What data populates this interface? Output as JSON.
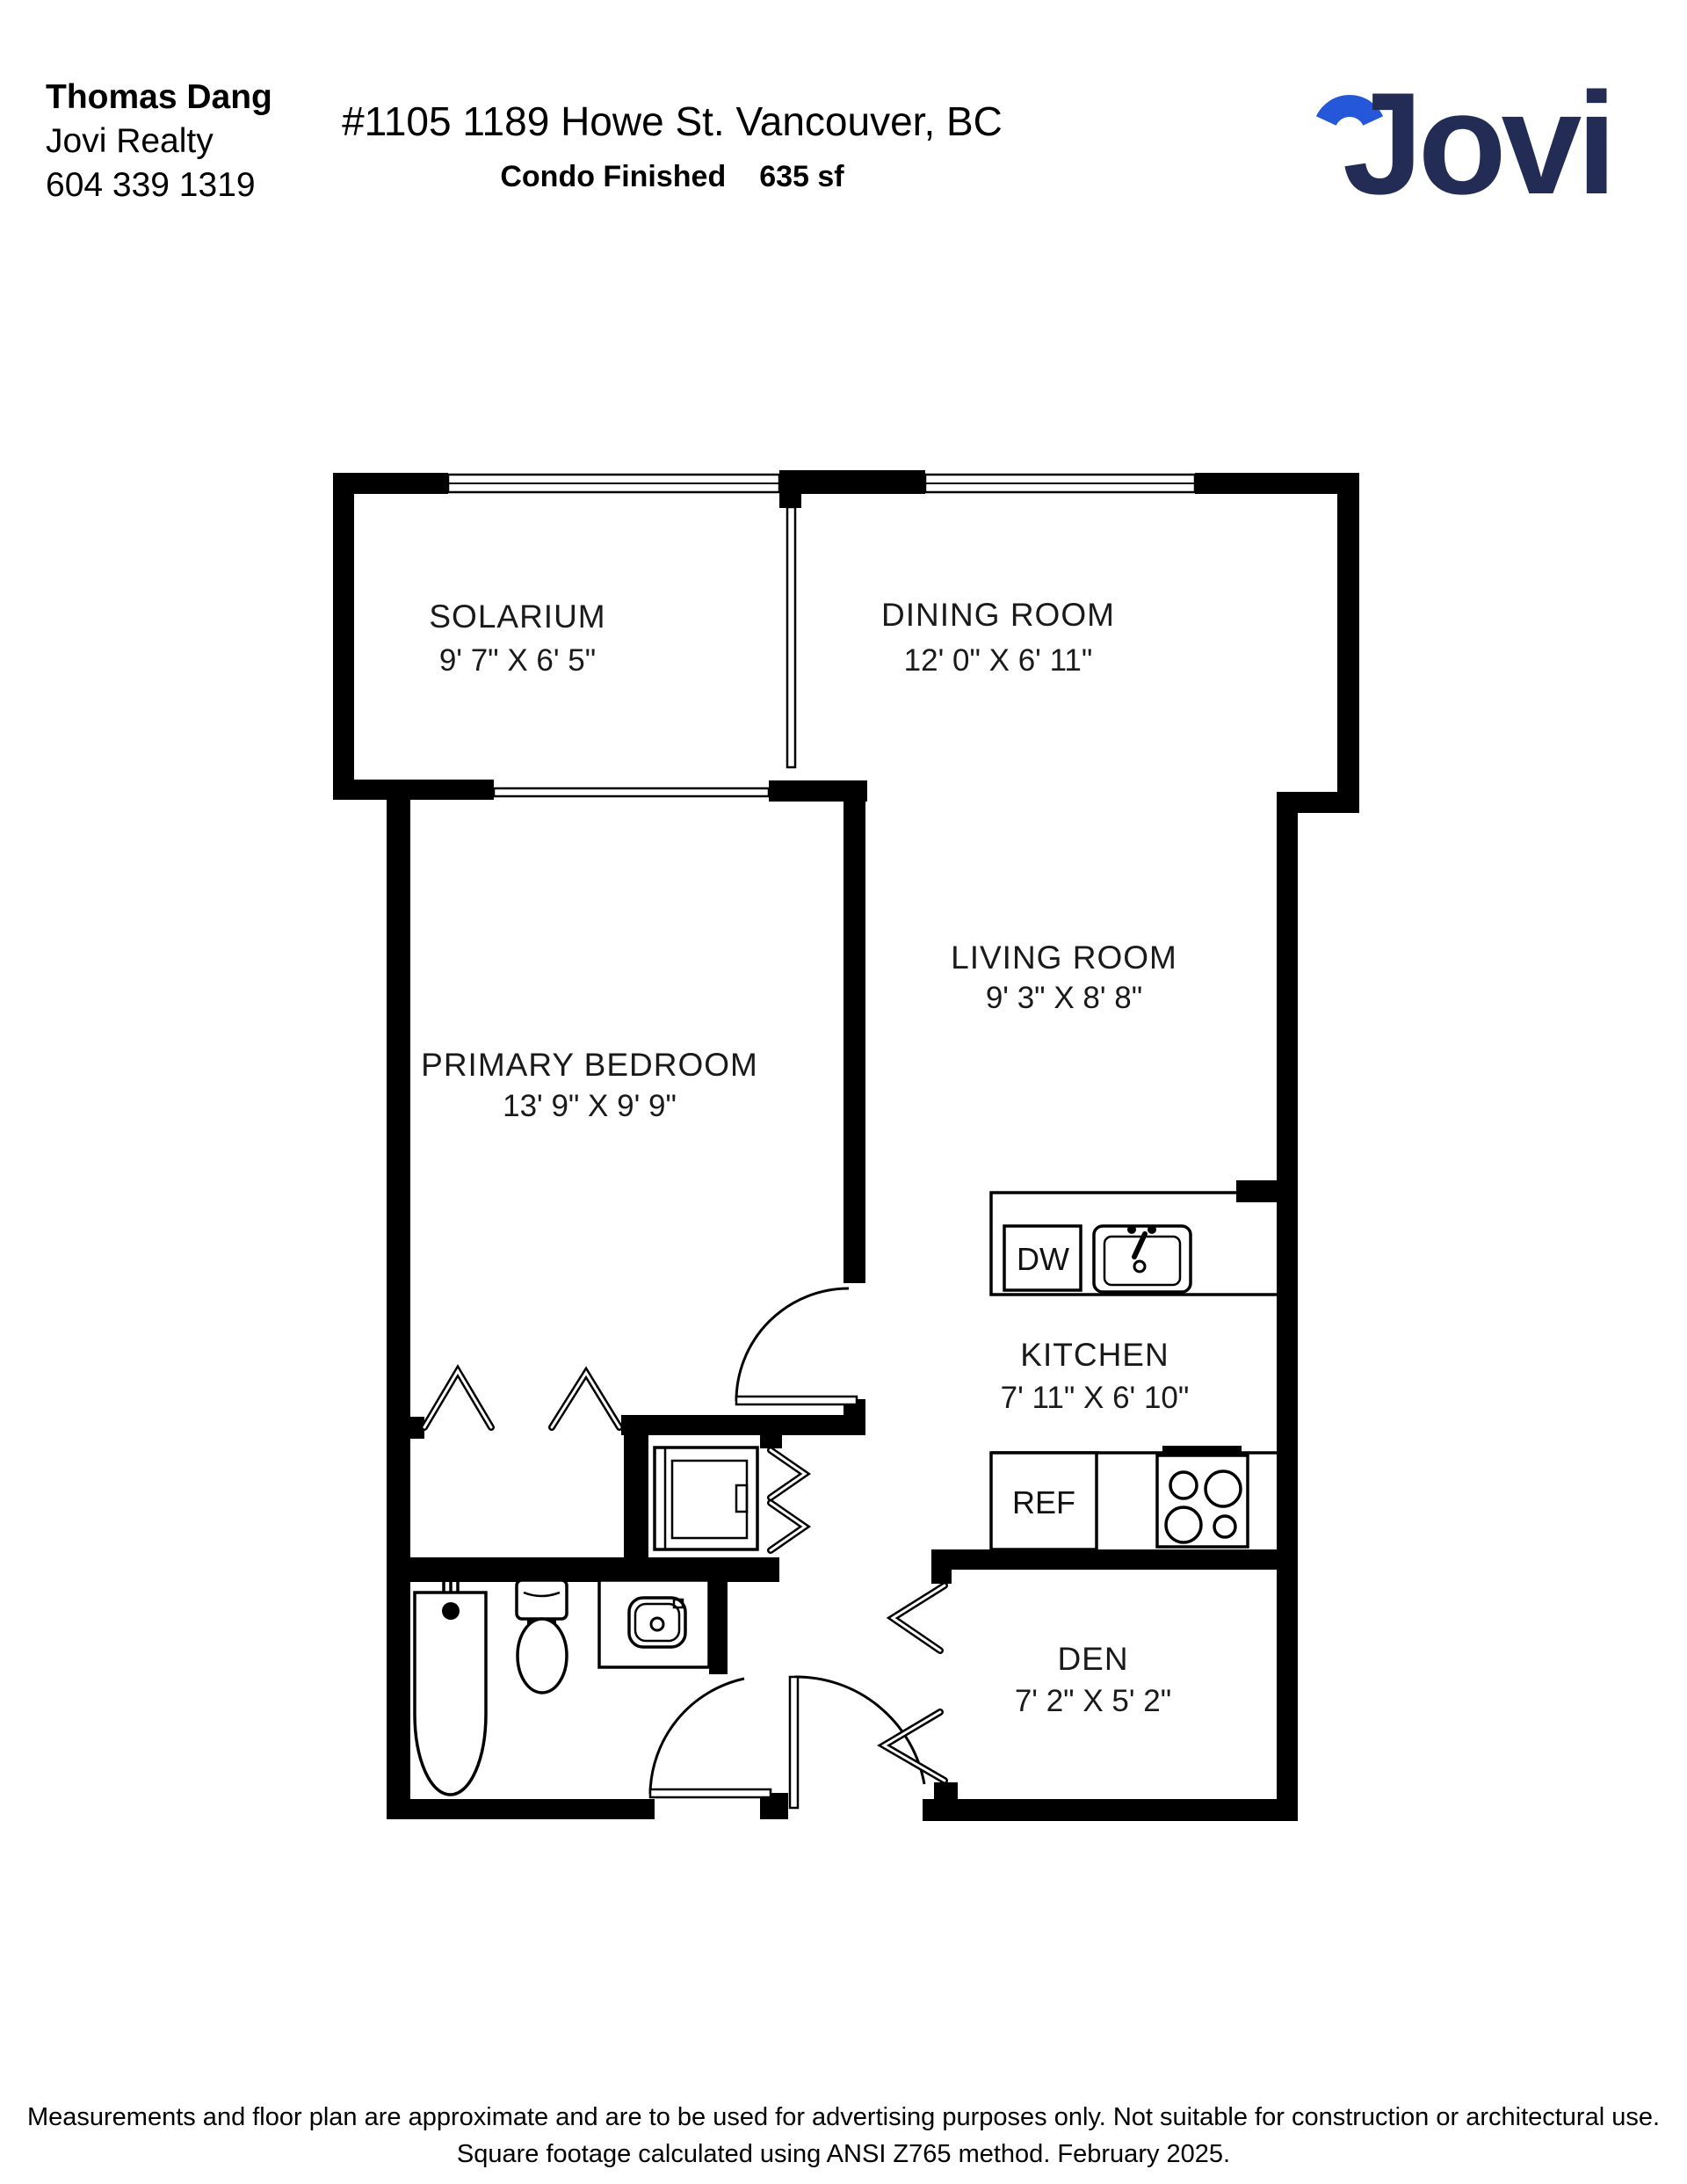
{
  "header": {
    "agent_name": "Thomas Dang",
    "agency": "Jovi Realty",
    "phone": "604 339 1319",
    "address": "#1105 1189 Howe St. Vancouver, BC",
    "subtitle_type": "Condo Finished",
    "subtitle_area": "635 sf",
    "logo_text": "Jovi"
  },
  "colors": {
    "logo_navy": "#232c55",
    "logo_blue": "#2458d8",
    "wall": "#000000"
  },
  "rooms": [
    {
      "id": "solarium",
      "name": "SOLARIUM",
      "dims": "9' 7\" X 6' 5\""
    },
    {
      "id": "dining",
      "name": "DINING ROOM",
      "dims": "12' 0\" X 6' 11\""
    },
    {
      "id": "living",
      "name": "LIVING ROOM",
      "dims": "9' 3\" X 8' 8\""
    },
    {
      "id": "bedroom",
      "name": "PRIMARY BEDROOM",
      "dims": "13' 9\" X 9' 9\""
    },
    {
      "id": "kitchen",
      "name": "KITCHEN",
      "dims": "7' 11\" X 6' 10\""
    },
    {
      "id": "den",
      "name": "DEN",
      "dims": "7' 2\" X 5' 2\""
    }
  ],
  "labels": {
    "dw": "DW",
    "ref": "REF"
  },
  "footer": {
    "line1": "Measurements and floor plan are approximate and are to be used for advertising purposes only. Not suitable for construction or architectural use.",
    "line2": "Square footage calculated using ANSI Z765 method. February 2025."
  }
}
